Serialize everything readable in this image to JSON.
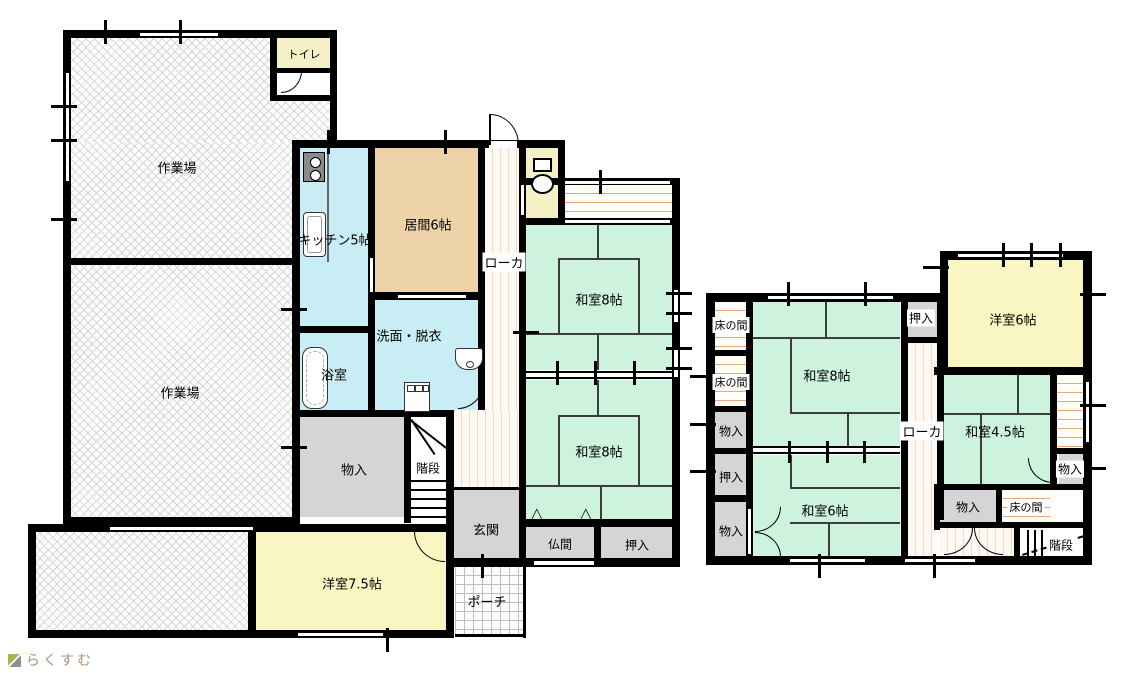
{
  "plan": {
    "type": "floorplan",
    "left_building": {
      "workshop1": "作業場",
      "workshop2": "作業場",
      "toilet_top": "トイレ",
      "kitchen": "キッチン5帖",
      "living": "居間6帖",
      "corridor": "ローカ",
      "washroom": "洗面・脱衣",
      "bath": "浴室",
      "storage": "物入",
      "stairs": "階段",
      "entrance": "玄関",
      "butsuma": "仏間",
      "oshiire": "押入",
      "tatami8_1": "和室8帖",
      "tatami8_2": "和室8帖",
      "western75": "洋室7.5帖",
      "porch": "ポーチ"
    },
    "right_building": {
      "tokonoma1": "床の間",
      "tokonoma2": "床の間",
      "storage1": "物入",
      "oshiire_left": "押入",
      "storage2": "物入",
      "tatami8": "和室8帖",
      "tatami6": "和室6帖",
      "oshiire_top": "押入",
      "corridor": "ローカ",
      "western6": "洋室6帖",
      "tatami45": "和室4.5帖",
      "storage_right": "物入",
      "storage_bottom": "物入",
      "tokonoma_bottom": "床の間",
      "stairs": "階段"
    },
    "logo": {
      "text": "らくすむ"
    },
    "colors": {
      "tatami_green": "#cdf2de",
      "living_tan": "#eed2a8",
      "wet_blue": "#c9edf4",
      "western_yellow": "#f9f6c2",
      "closet_gray": "#d5d5d5",
      "engawa_stripe": "#e7a87e",
      "wall_black": "#000000"
    }
  }
}
